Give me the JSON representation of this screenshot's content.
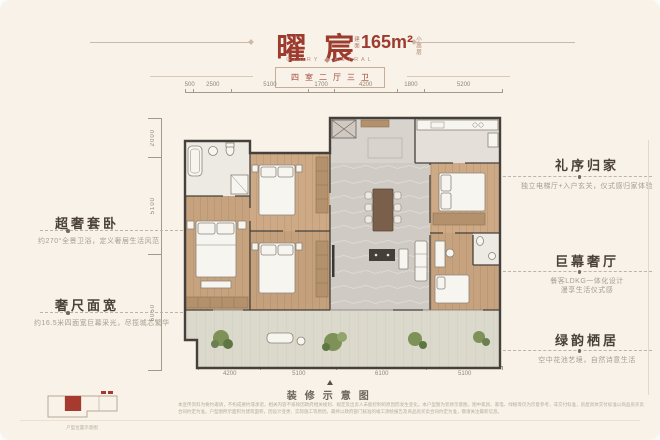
{
  "header": {
    "title": "曜宸",
    "area_label": "建面",
    "area_value": "165m²",
    "area_suffix": "小高层",
    "brand_left": "GLORY",
    "brand_right": "ASTRAL",
    "layout": "四室二厅三卫"
  },
  "dimensions": {
    "top": [
      "500",
      "2500",
      "5100",
      "1700",
      "4200",
      "1800",
      "5200"
    ],
    "left": [
      "2000",
      "5100",
      "6050"
    ],
    "bottom": [
      "4200",
      "5100",
      "6100",
      "5100"
    ]
  },
  "callouts_left": [
    {
      "title": "超奢套卧",
      "desc": "约270°全景卫浴，定义奢居生活风范"
    },
    {
      "title": "奢尺面宽",
      "desc": "约16.5米四面宽巨幕采光，尽揽城芯繁华"
    }
  ],
  "callouts_right": [
    {
      "title": "礼序归家",
      "desc": "独立电梯厅+入户玄关，仪式感归家体验"
    },
    {
      "title": "巨幕奢厅",
      "desc": "餐客LDKG一体化设计",
      "desc2": "漫享生活仪式感"
    },
    {
      "title": "绿韵栖居",
      "desc": "空中花池艺境，自然诗意生活"
    }
  ],
  "footer": {
    "caption": "装修示意图",
    "disclaimer": "本宣传资料为要约邀请，不构成要约或承诺，相关内容不排除因政府相关规划、规定及出卖人未能控制的原因而发生变化。本户型图为装修示意图，图中家具、家电、绿植等仅为示意参考，非交付标准，房屋具体交付标准以商品房买卖合同约定为准。户型图所示面积为建筑面积，因设计变更、实际施工等原因，最终以政府部门核准的竣工测绘报告及商品房买卖合同约定为准，敬请关注最新信息。"
  },
  "inset": {
    "caption": "户型位置示意图"
  },
  "colors": {
    "accent": "#9c3b2e",
    "background": "#f8f2e8",
    "wall": "#45403b",
    "wood": "#c7a27e"
  }
}
